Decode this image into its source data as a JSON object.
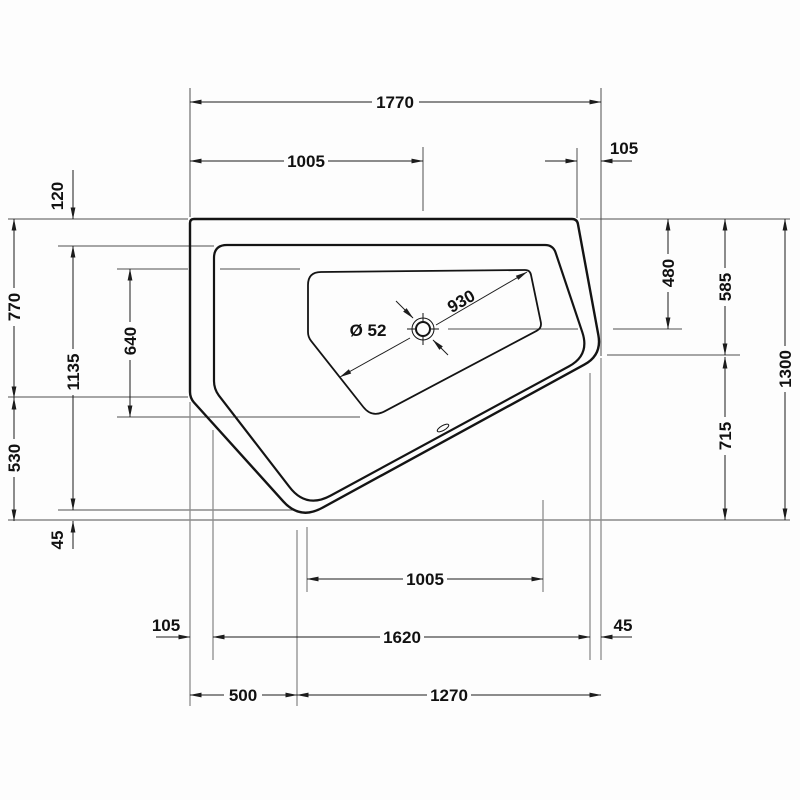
{
  "drawing": {
    "title": "corner-bathtub-plan-view-technical-drawing",
    "units": "mm",
    "colors": {
      "background": "#fdfdfd",
      "contour_line": "#141414",
      "dimension_line": "#1c1c1c",
      "extension_line": "#8d8d8d",
      "text": "#111111"
    },
    "dims": {
      "top_overall": "1770",
      "top_span": "1005",
      "top_right_offset": "105",
      "left_rim": "120",
      "left_upper": "770",
      "left_inner": "1135",
      "left_basin": "640",
      "left_lower": "530",
      "left_tip": "45",
      "right_drain": "480",
      "right_upper": "585",
      "right_lower": "715",
      "right_overall": "1300",
      "bottom_span": "1005",
      "bottom_left_offset": "105",
      "bottom_inner": "1620",
      "bottom_right_offset": "45",
      "bottom_left": "500",
      "bottom_right": "1270",
      "diagonal": "930",
      "drain": "Ø 52"
    }
  }
}
